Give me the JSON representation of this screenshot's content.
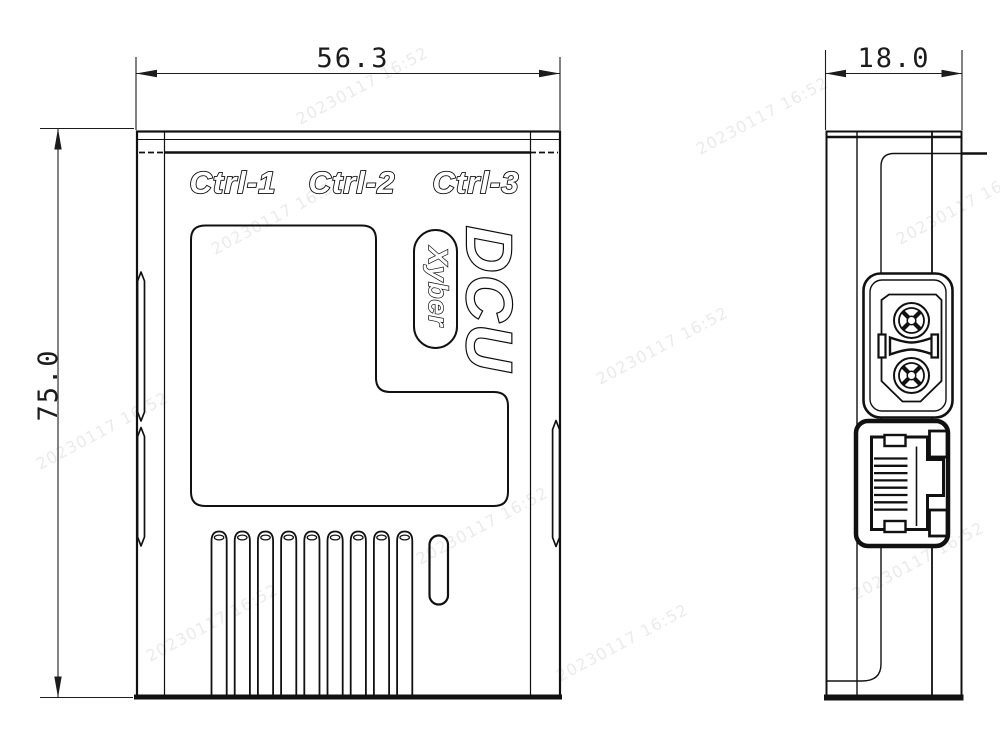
{
  "front_view": {
    "port_labels": [
      "Ctrl-1",
      "Ctrl-2",
      "Ctrl-3"
    ],
    "logo": "DCU",
    "brand": "Xyber",
    "dim_width": "56.3",
    "dim_height": "75.0"
  },
  "side_view": {
    "dim_depth": "18.0"
  },
  "watermark": {
    "text": "20230117 16:52"
  },
  "colors": {
    "line": "#111111",
    "background": "#ffffff"
  }
}
